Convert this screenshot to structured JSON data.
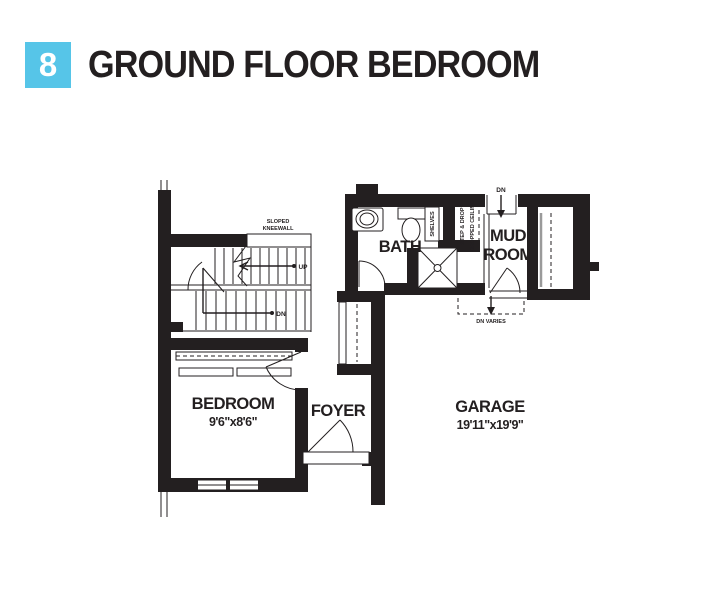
{
  "header": {
    "number": "8",
    "title": "GROUND FLOOR BEDROOM"
  },
  "colors": {
    "accent": "#56C5E8",
    "ink": "#231F20"
  },
  "rooms": {
    "bedroom": {
      "name": "BEDROOM",
      "dims": "9'6\"x8'6\""
    },
    "foyer": {
      "name": "FOYER"
    },
    "bath": {
      "name": "BATH"
    },
    "mudroom": {
      "line1": "MUD",
      "line2": "ROOM"
    },
    "garage": {
      "name": "GARAGE",
      "dims": "19'11\"x19'9\""
    }
  },
  "annotations": {
    "kneewall_line1": "SLOPED",
    "kneewall_line2": "KNEEWALL",
    "up": "UP",
    "dn_stairs": "DN",
    "shelves": "SHELVES",
    "step_drop": "STEP & DROP",
    "dropped_ceiling": "DROPPED CEILING",
    "dn_mudroom_top": "DN",
    "dn_varies": "DN VARIES"
  }
}
